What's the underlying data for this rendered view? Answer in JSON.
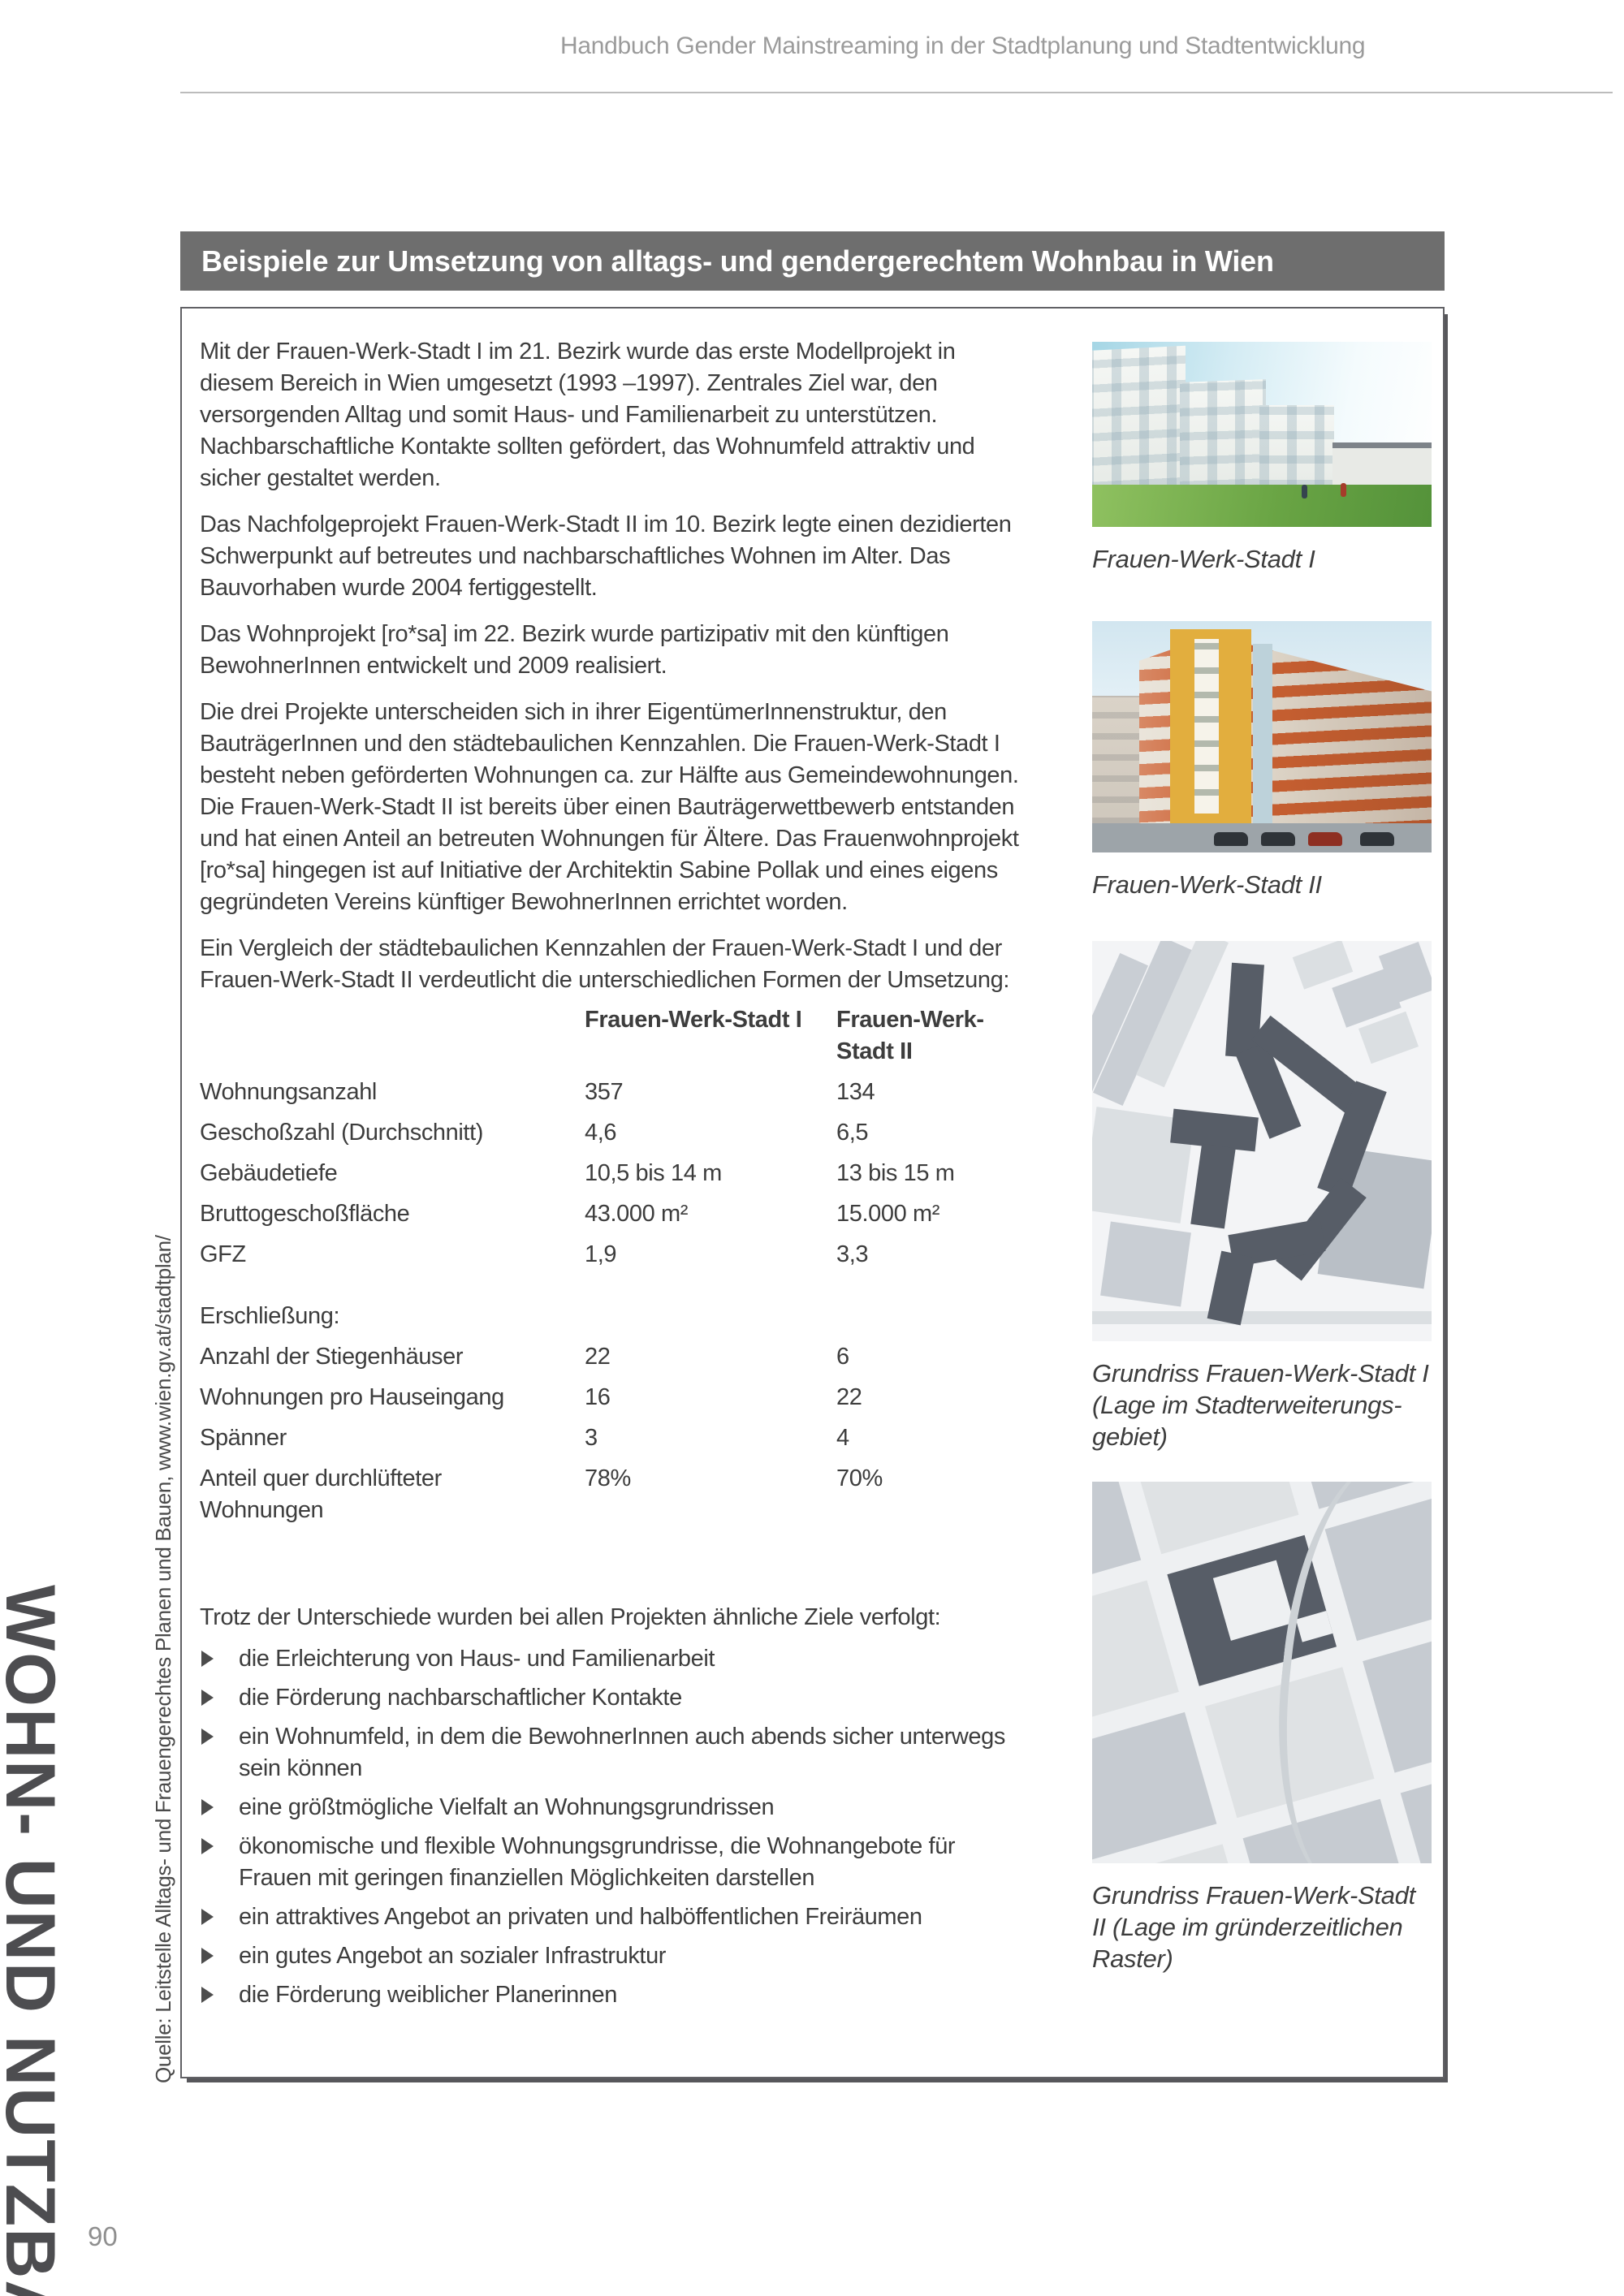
{
  "page": {
    "header_title": "Handbuch Gender Mainstreaming in der Stadtplanung und Stadtentwicklung",
    "page_number": "90",
    "margin_vertical_title": "WOHN- UND NUTZBAU",
    "margin_source": "Quelle: Leitstelle Alltags- und Frauengerechtes Planen und Bauen, www.wien.gv.at/stadtplan/"
  },
  "section": {
    "title_bar": "Beispiele zur Umsetzung von alltags- und gendergerechtem Wohnbau in Wien"
  },
  "article": {
    "paragraphs": [
      "Mit der Frauen-Werk-Stadt I im 21. Bezirk wurde das erste Modellprojekt in diesem Bereich in Wien umgesetzt (1993 –1997). Zentrales Ziel war, den versorgenden Alltag und somit Haus- und Familienarbeit zu unterstützen. Nachbarschaftliche Kontakte sollten gefördert, das Wohnumfeld attraktiv und sicher gestaltet werden.",
      "Das Nachfolgeprojekt Frauen-Werk-Stadt II im 10. Bezirk legte einen dezidierten Schwerpunkt auf betreutes und nachbarschaftliches Wohnen im Alter. Das Bauvorhaben wurde 2004 fertiggestellt.",
      "Das Wohnprojekt [ro*sa] im 22. Bezirk wurde partizipativ mit den künftigen BewohnerInnen entwickelt und 2009 realisiert.",
      "Die drei Projekte unterscheiden sich in ihrer EigentümerInnenstruktur, den BauträgerInnen und den städtebaulichen Kennzahlen. Die Frauen-Werk-Stadt I besteht neben geförderten Wohnungen ca. zur Hälfte aus Gemeindewohnungen. Die Frauen-Werk-Stadt II ist bereits über einen Bauträgerwettbewerb entstanden und hat einen Anteil an betreuten Wohnungen für Ältere. Das Frauenwohnprojekt [ro*sa] hingegen ist auf Initiative der Architektin Sabine Pollak und eines eigens gegründeten Vereins künftiger BewohnerInnen errichtet worden.",
      "Ein Vergleich der städtebaulichen Kennzahlen der Frauen-Werk-Stadt I und der Frauen-Werk-Stadt II verdeutlicht die unterschiedlichen Formen der Umsetzung:"
    ]
  },
  "comparison_table": {
    "columns": [
      "Frauen-Werk-Stadt I",
      "Frauen-Werk-Stadt II"
    ],
    "rows": [
      {
        "label": "Wohnungsanzahl",
        "v1": "357",
        "v2": "134"
      },
      {
        "label": "Geschoßzahl (Durchschnitt)",
        "v1": "4,6",
        "v2": "6,5"
      },
      {
        "label": "Gebäudetiefe",
        "v1": "10,5 bis 14 m",
        "v2": "13 bis 15 m"
      },
      {
        "label": "Bruttogeschoßfläche",
        "v1": "43.000 m²",
        "v2": "15.000 m²"
      },
      {
        "label": "GFZ",
        "v1": "1,9",
        "v2": "3,3"
      },
      {
        "label": "Erschließung:",
        "v1": "",
        "v2": ""
      },
      {
        "label": "Anzahl der Stiegenhäuser",
        "v1": "22",
        "v2": "6"
      },
      {
        "label": "Wohnungen pro Hauseingang",
        "v1": "16",
        "v2": "22"
      },
      {
        "label": "Spänner",
        "v1": "3",
        "v2": "4"
      },
      {
        "label": "Anteil quer durchlüfteter Wohnungen",
        "v1": "78%",
        "v2": "70%"
      }
    ]
  },
  "goals": {
    "intro": "Trotz der Unterschiede wurden bei allen Projekten ähnliche Ziele verfolgt:",
    "items": [
      "die Erleichterung von Haus- und Familienarbeit",
      "die Förderung nachbarschaftlicher Kontakte",
      "ein Wohnumfeld, in dem die BewohnerInnen auch abends sicher unterwegs sein können",
      "eine größtmögliche Vielfalt an Wohnungsgrundrissen",
      "ökonomische und flexible Wohnungsgrundrisse, die Wohnangebote für Frauen mit geringen finanziellen Möglichkeiten darstellen",
      "ein attraktives Angebot an privaten und halböffentlichen Freiräumen",
      "ein gutes Angebot an sozialer Infrastruktur",
      "die Förderung weiblicher Planerinnen"
    ]
  },
  "figures": [
    {
      "caption": "Frauen-Werk-Stadt I"
    },
    {
      "caption": "Frauen-Werk-Stadt II"
    },
    {
      "caption": "Grundriss Frauen-Werk-Stadt I (Lage im Stadterweiterungs-gebiet)"
    },
    {
      "caption": "Grundriss Frauen-Werk-Stadt II (Lage im gründerzeitlichen Raster)"
    }
  ],
  "colors": {
    "section_bar": "#6e6e6e",
    "section_title_text": "#ffffff",
    "body_text": "#3d3d3d",
    "running_head_text": "#9b9b9b",
    "box_border": "#616165",
    "vertical_title": "#4d4d50"
  }
}
